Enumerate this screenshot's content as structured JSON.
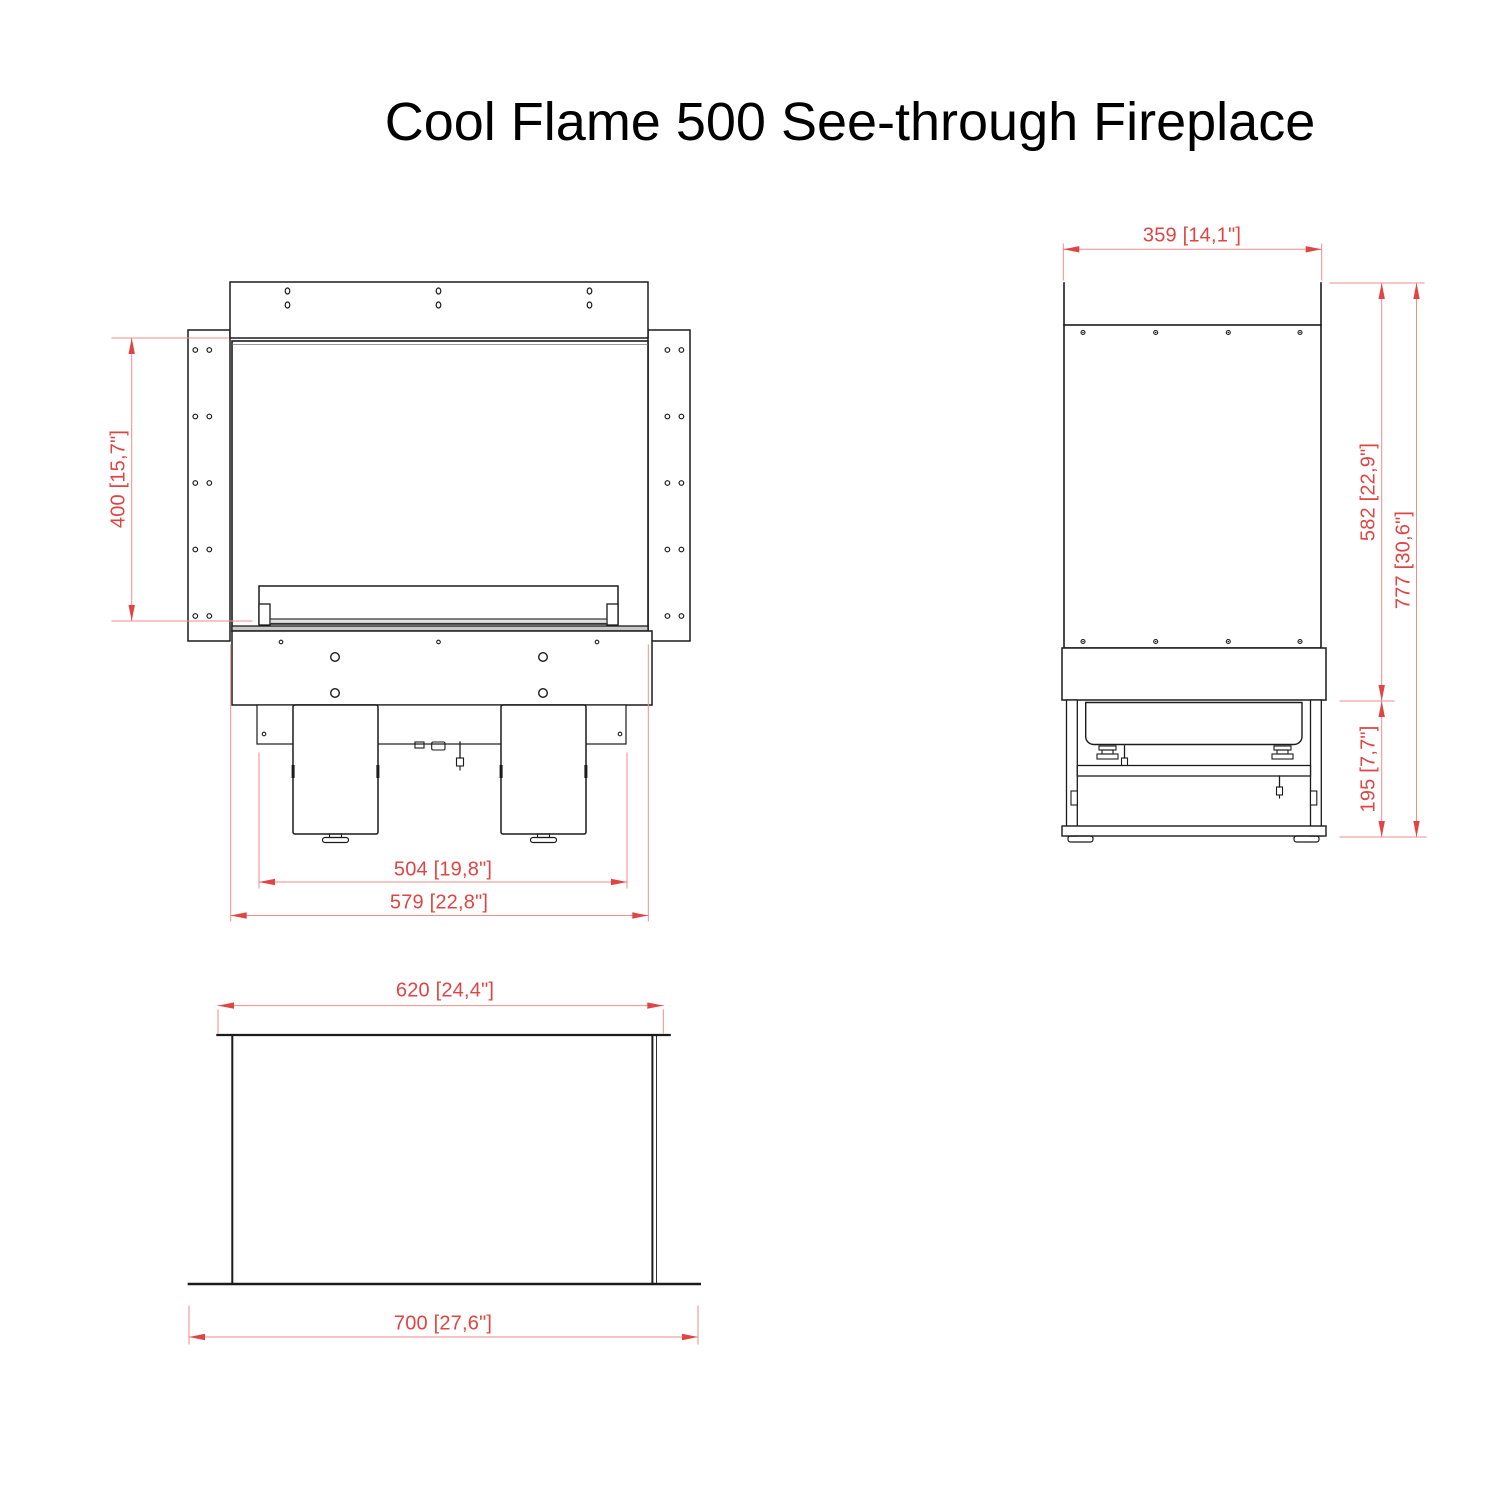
{
  "title": "Cool Flame 500 See-through Fireplace",
  "views": {
    "front": {
      "dim_height": "400 [15,7\"]",
      "dim_leg_span": "504 [19,8\"]",
      "dim_width": "579 [22,8\"]"
    },
    "side": {
      "dim_depth": "359 [14,1\"]",
      "dim_body_height": "582 [22,9\"]",
      "dim_total_height": "777 [30,6\"]",
      "dim_base_height": "195 [7,7\"]"
    },
    "bottom": {
      "dim_inner_width": "620 [24,4\"]",
      "dim_outer_width": "700 [27,6\"]"
    }
  },
  "colors": {
    "dimension_text": "#e04543",
    "dimension_line": "#ee8e8c",
    "drawing_line": "#1b1b1b"
  }
}
